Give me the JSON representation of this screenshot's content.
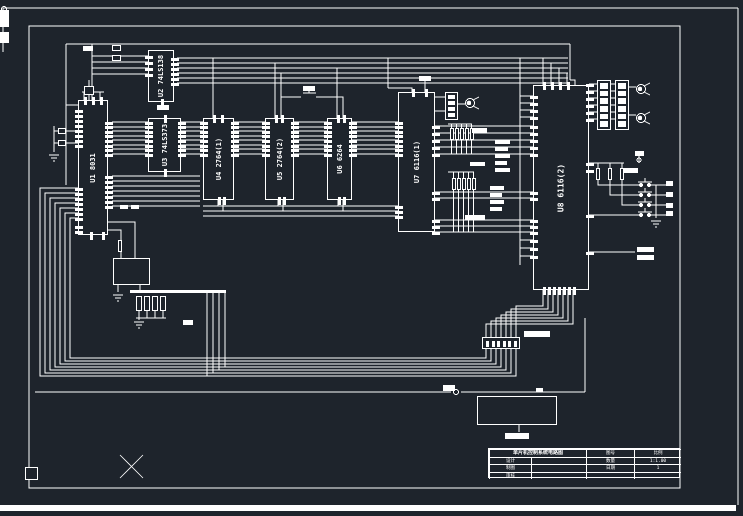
{
  "window": {
    "width": 743,
    "height": 516,
    "background": "#1e242c",
    "line_color": "#ffffff"
  },
  "drawing": {
    "type": "microcontroller schematic",
    "chips": [
      {
        "ref": "U1",
        "part": "8031",
        "label": "U1 8031",
        "x": 78,
        "y": 100,
        "w": 30,
        "h": 135,
        "pins": {
          "left": [
            {
              "s": 110,
              "n": 8,
              "st": 5
            },
            {
              "s": 188,
              "n": 7,
              "st": 5
            },
            {
              "s": 226,
              "n": 2,
              "st": 5
            }
          ],
          "right": [
            {
              "s": 122,
              "n": 8,
              "st": 4.6
            },
            {
              "s": 176,
              "n": 7,
              "st": 5
            }
          ],
          "top": [
            {
              "s": 84,
              "n": 3,
              "st": 8
            }
          ],
          "bottom": [
            {
              "s": 90,
              "n": 2,
              "st": 12
            }
          ]
        }
      },
      {
        "ref": "U2",
        "part": "74LS138",
        "label": "U2 74LS138",
        "x": 148,
        "y": 50,
        "w": 26,
        "h": 52,
        "pins": {
          "left": [
            {
              "s": 56,
              "n": 4,
              "st": 6
            }
          ],
          "right": [
            {
              "s": 58,
              "n": 6,
              "st": 5
            }
          ],
          "top": [],
          "bottom": [
            {
              "s": 161,
              "n": 1,
              "st": 5
            }
          ]
        }
      },
      {
        "ref": "U3",
        "part": "74LS373",
        "label": "U3 74LS373",
        "x": 148,
        "y": 118,
        "w": 33,
        "h": 54,
        "pins": {
          "left": [
            {
              "s": 122,
              "n": 8,
              "st": 4.6
            }
          ],
          "right": [
            {
              "s": 122,
              "n": 8,
              "st": 4.6
            }
          ],
          "top": [
            {
              "s": 164,
              "n": 1,
              "st": 5
            }
          ],
          "bottom": [
            {
              "s": 164,
              "n": 1,
              "st": 5
            }
          ]
        }
      },
      {
        "ref": "U4",
        "part": "2764(1)",
        "label": "U4 2764(1)",
        "x": 203,
        "y": 118,
        "w": 31,
        "h": 82,
        "pins": {
          "left": [
            {
              "s": 122,
              "n": 8,
              "st": 4.6
            }
          ],
          "right": [
            {
              "s": 122,
              "n": 8,
              "st": 4.6
            }
          ],
          "top": [
            {
              "s": 213,
              "n": 2,
              "st": 8
            }
          ],
          "bottom": [
            {
              "s": 218,
              "n": 2,
              "st": 5
            }
          ]
        }
      },
      {
        "ref": "U5",
        "part": "2764(2)",
        "label": "U5 2764(2)",
        "x": 265,
        "y": 118,
        "w": 29,
        "h": 82,
        "pins": {
          "left": [
            {
              "s": 122,
              "n": 8,
              "st": 4.6
            }
          ],
          "right": [
            {
              "s": 122,
              "n": 8,
              "st": 4.6
            }
          ],
          "top": [
            {
              "s": 275,
              "n": 2,
              "st": 6
            }
          ],
          "bottom": [
            {
              "s": 278,
              "n": 2,
              "st": 5
            }
          ]
        }
      },
      {
        "ref": "U6",
        "part": "6264",
        "label": "U6 6264",
        "x": 327,
        "y": 118,
        "w": 25,
        "h": 82,
        "pins": {
          "left": [
            {
              "s": 122,
              "n": 8,
              "st": 4.6
            }
          ],
          "right": [
            {
              "s": 122,
              "n": 8,
              "st": 4.6
            }
          ],
          "top": [
            {
              "s": 337,
              "n": 2,
              "st": 6
            }
          ],
          "bottom": [
            {
              "s": 338,
              "n": 2,
              "st": 5
            }
          ]
        }
      },
      {
        "ref": "U7",
        "part": "6116(1)",
        "label": "U7 6116(1)",
        "x": 398,
        "y": 92,
        "w": 37,
        "h": 140,
        "pins": {
          "left": [
            {
              "s": 122,
              "n": 8,
              "st": 4.6
            },
            {
              "s": 206,
              "n": 3,
              "st": 5
            }
          ],
          "right": [
            {
              "s": 126,
              "n": 5,
              "st": 7
            },
            {
              "s": 192,
              "n": 2,
              "st": 6
            },
            {
              "s": 220,
              "n": 3,
              "st": 6
            }
          ],
          "top": [
            {
              "s": 412,
              "n": 2,
              "st": 13
            }
          ],
          "bottom": []
        }
      },
      {
        "ref": "U8",
        "part": "6116(2)",
        "label": "U8 6116(2)",
        "x": 533,
        "y": 85,
        "w": 56,
        "h": 205,
        "pins": {
          "left": [
            {
              "s": 96,
              "n": 4,
              "st": 7
            },
            {
              "s": 126,
              "n": 5,
              "st": 7
            },
            {
              "s": 192,
              "n": 2,
              "st": 6
            },
            {
              "s": 220,
              "n": 3,
              "st": 6
            },
            {
              "s": 240,
              "n": 3,
              "st": 8
            }
          ],
          "right": [
            {
              "s": 84,
              "n": 6,
              "st": 7
            },
            {
              "s": 163,
              "n": 2,
              "st": 7
            },
            {
              "s": 215,
              "n": 1,
              "st": 5
            },
            {
              "s": 252,
              "n": 1,
              "st": 5
            }
          ],
          "top": [
            {
              "s": 543,
              "n": 4,
              "st": 8
            }
          ],
          "bottom": [
            {
              "s": 543,
              "n": 7,
              "st": 5
            }
          ]
        }
      }
    ],
    "components": {
      "dip_packs": [
        {
          "name": "resistor-pack-1",
          "x": 597,
          "y": 80,
          "w": 14,
          "h": 50,
          "cells": 6
        },
        {
          "name": "resistor-pack-2",
          "x": 615,
          "y": 80,
          "w": 14,
          "h": 50,
          "cells": 6
        },
        {
          "name": "resistor-pack-3",
          "x": 445,
          "y": 92,
          "w": 13,
          "h": 28,
          "cells": 4
        }
      ],
      "transistors": [
        {
          "x": 641,
          "y": 89
        },
        {
          "x": 641,
          "y": 118
        },
        {
          "x": 470,
          "y": 103
        }
      ],
      "buttons": [
        {
          "x": 645,
          "y": 185
        },
        {
          "x": 645,
          "y": 195
        },
        {
          "x": 645,
          "y": 205
        },
        {
          "x": 645,
          "y": 215
        }
      ],
      "resistors": [
        {
          "x": 596,
          "y": 168
        },
        {
          "x": 608,
          "y": 168
        },
        {
          "x": 620,
          "y": 168
        },
        {
          "x": 450,
          "y": 128
        },
        {
          "x": 455,
          "y": 128
        },
        {
          "x": 460,
          "y": 128
        },
        {
          "x": 465,
          "y": 128
        },
        {
          "x": 470,
          "y": 128
        },
        {
          "x": 452,
          "y": 178
        },
        {
          "x": 457,
          "y": 178
        },
        {
          "x": 462,
          "y": 178
        },
        {
          "x": 467,
          "y": 178
        },
        {
          "x": 472,
          "y": 178
        },
        {
          "x": 118,
          "y": 240
        }
      ],
      "connector": {
        "x": 482,
        "y": 337,
        "w": 38,
        "h": 12,
        "pins": 7
      },
      "bottom_box": {
        "x": 477,
        "y": 396,
        "w": 80,
        "h": 29
      },
      "opto_box": {
        "x": 113,
        "y": 258,
        "w": 37,
        "h": 27
      },
      "contact_bank": {
        "x": 136,
        "y": 296,
        "cellw": 6,
        "cellh": 15,
        "gap": 8,
        "cells": 4
      },
      "bus_bar": {
        "x": 130,
        "y": 290,
        "w": 96,
        "h": 3
      },
      "corner_square": {
        "x": 25,
        "y": 467,
        "w": 13,
        "h": 13
      },
      "left_tabs": [
        {
          "x": 0,
          "y": 10,
          "w": 9,
          "h": 17
        },
        {
          "x": 0,
          "y": 32,
          "w": 9,
          "h": 11
        }
      ],
      "bottom_strip": {
        "x": 0,
        "y": 505,
        "w": 736,
        "h": 6
      },
      "crystal_caps": [
        {
          "x": 58,
          "y": 128,
          "w": 8,
          "h": 6
        },
        {
          "x": 58,
          "y": 140,
          "w": 8,
          "h": 6
        }
      ],
      "misc_outlines": [
        {
          "x": 84,
          "y": 86,
          "w": 10,
          "h": 9
        },
        {
          "x": 112,
          "y": 45,
          "w": 9,
          "h": 6
        },
        {
          "x": 112,
          "y": 55,
          "w": 9,
          "h": 6
        }
      ],
      "net_label_blobs": [
        {
          "x": 83,
          "y": 46,
          "w": 10,
          "h": 5
        },
        {
          "x": 157,
          "y": 105,
          "w": 12,
          "h": 5
        },
        {
          "x": 303,
          "y": 86,
          "w": 12,
          "h": 5
        },
        {
          "x": 419,
          "y": 76,
          "w": 12,
          "h": 5
        },
        {
          "x": 472,
          "y": 128,
          "w": 15,
          "h": 5
        },
        {
          "x": 495,
          "y": 140,
          "w": 15,
          "h": 4
        },
        {
          "x": 495,
          "y": 147,
          "w": 13,
          "h": 4
        },
        {
          "x": 495,
          "y": 154,
          "w": 15,
          "h": 4
        },
        {
          "x": 495,
          "y": 161,
          "w": 12,
          "h": 4
        },
        {
          "x": 495,
          "y": 168,
          "w": 15,
          "h": 4
        },
        {
          "x": 470,
          "y": 162,
          "w": 15,
          "h": 4
        },
        {
          "x": 490,
          "y": 186,
          "w": 14,
          "h": 4
        },
        {
          "x": 490,
          "y": 193,
          "w": 12,
          "h": 4
        },
        {
          "x": 490,
          "y": 200,
          "w": 14,
          "h": 4
        },
        {
          "x": 490,
          "y": 207,
          "w": 12,
          "h": 4
        },
        {
          "x": 465,
          "y": 215,
          "w": 20,
          "h": 5
        },
        {
          "x": 120,
          "y": 205,
          "w": 8,
          "h": 4
        },
        {
          "x": 131,
          "y": 205,
          "w": 8,
          "h": 4
        },
        {
          "x": 183,
          "y": 320,
          "w": 10,
          "h": 5
        },
        {
          "x": 443,
          "y": 385,
          "w": 12,
          "h": 6
        },
        {
          "x": 536,
          "y": 388,
          "w": 7,
          "h": 4
        },
        {
          "x": 505,
          "y": 433,
          "w": 24,
          "h": 6
        },
        {
          "x": 524,
          "y": 331,
          "w": 26,
          "h": 6
        },
        {
          "x": 635,
          "y": 151,
          "w": 9,
          "h": 5
        },
        {
          "x": 624,
          "y": 168,
          "w": 14,
          "h": 5
        },
        {
          "x": 637,
          "y": 247,
          "w": 17,
          "h": 5
        },
        {
          "x": 637,
          "y": 255,
          "w": 17,
          "h": 5
        },
        {
          "x": 666,
          "y": 181,
          "w": 7,
          "h": 5
        },
        {
          "x": 666,
          "y": 192,
          "w": 7,
          "h": 5
        },
        {
          "x": 666,
          "y": 203,
          "w": 7,
          "h": 5
        },
        {
          "x": 666,
          "y": 211,
          "w": 7,
          "h": 5
        }
      ]
    },
    "title_block": {
      "x": 488,
      "y": 448,
      "col_widths": [
        42,
        55,
        48,
        47
      ],
      "row_height": 7.5,
      "rows": [
        {
          "cells": [
            {
              "span": 2,
              "text": "单片机控制系统电路图",
              "title": true
            },
            {
              "text": "图号"
            },
            {
              "text": "比例"
            }
          ]
        },
        {
          "cells": [
            {
              "text": "设计"
            },
            {
              "text": ""
            },
            {
              "text": "数量"
            },
            {
              "text": "1:1.00"
            }
          ]
        },
        {
          "cells": [
            {
              "text": "制图"
            },
            {
              "text": ""
            },
            {
              "text": "日期"
            },
            {
              "text": "1"
            }
          ]
        },
        {
          "cells": [
            {
              "text": "审核"
            },
            {
              "text": ""
            },
            {
              "text": ""
            },
            {
              "text": ""
            }
          ]
        }
      ]
    }
  }
}
